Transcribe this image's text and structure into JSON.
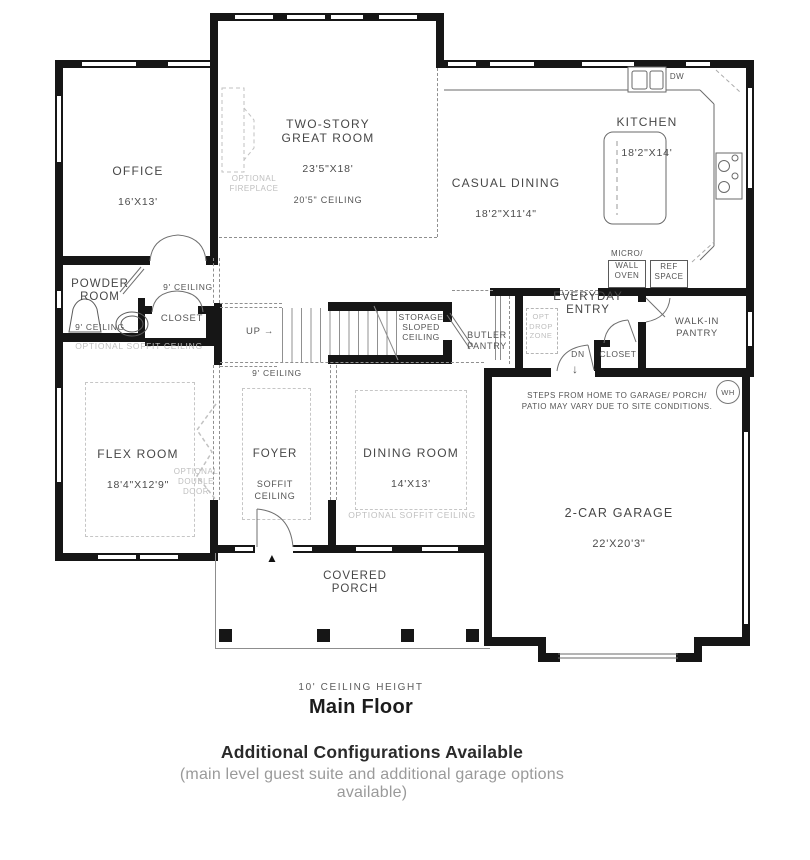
{
  "rooms": {
    "office": {
      "name": "OFFICE",
      "dims": "16'X13'"
    },
    "great_room": {
      "name": "TWO-STORY\nGREAT ROOM",
      "dims": "23'5\"X18'",
      "ceiling": "20'5\" CEILING"
    },
    "kitchen": {
      "name": "KITCHEN",
      "dims": "18'2\"X14'"
    },
    "casual_dining": {
      "name": "CASUAL DINING",
      "dims": "18'2\"X11'4\""
    },
    "powder_room": {
      "name": "POWDER\nROOM",
      "ceiling": "9' CEILING"
    },
    "hall": {
      "ceiling": "9' CEILING"
    },
    "closet_hall": {
      "name": "CLOSET"
    },
    "stairs": {
      "up": "UP",
      "up_arrow": "→"
    },
    "storage": {
      "name": "STORAGE\nSLOPED\nCEILING"
    },
    "butler_pantry": {
      "name": "BUTLER\nPANTRY"
    },
    "everyday_entry": {
      "name": "EVERYDAY\nENTRY"
    },
    "drop_zone": {
      "name": "OPT\nDROP\nZONE"
    },
    "dn": {
      "label": "DN",
      "arrow": "↓"
    },
    "closet_entry": {
      "name": "CLOSET"
    },
    "walk_in_pantry": {
      "name": "WALK-IN\nPANTRY"
    },
    "garage": {
      "name": "2-CAR GARAGE",
      "dims": "22'X20'3\"",
      "note": "STEPS FROM HOME TO GARAGE/ PORCH/\nPATIO MAY VARY DUE TO SITE CONDITIONS.",
      "water_heater": "WH"
    },
    "flex_room": {
      "name": "FLEX ROOM",
      "dims": "18'4\"X12'9\""
    },
    "foyer": {
      "name": "FOYER",
      "sub": "SOFFIT\nCEILING",
      "ceiling": "9' CEILING"
    },
    "dining_room": {
      "name": "DINING ROOM",
      "dims": "14'X13'"
    },
    "covered_porch": {
      "name": "COVERED\nPORCH"
    }
  },
  "annotations": {
    "optional_fireplace": "OPTIONAL\nFIREPLACE",
    "optional_soffit_flex": "OPTIONAL SOFFIT CEILING",
    "optional_soffit_dining": "OPTIONAL SOFFIT CEILING",
    "optional_double_door": "OPTIONAL\nDOUBLE\nDOOR",
    "dw": "DW",
    "micro": "MICRO/",
    "wall_oven": "WALL\nOVEN",
    "ref_space": "REF\nSPACE",
    "entry_marker": "▲"
  },
  "captions": {
    "ceiling_height": "10' CEILING HEIGHT",
    "floor_title": "Main Floor",
    "footer_bold": "Additional Configurations Available",
    "footer_sub": "(main level guest suite and additional garage options available)"
  },
  "colors": {
    "wall": "#161616",
    "line": "#6a6a6a",
    "muted": "#bfbfbf",
    "text": "#474747"
  }
}
